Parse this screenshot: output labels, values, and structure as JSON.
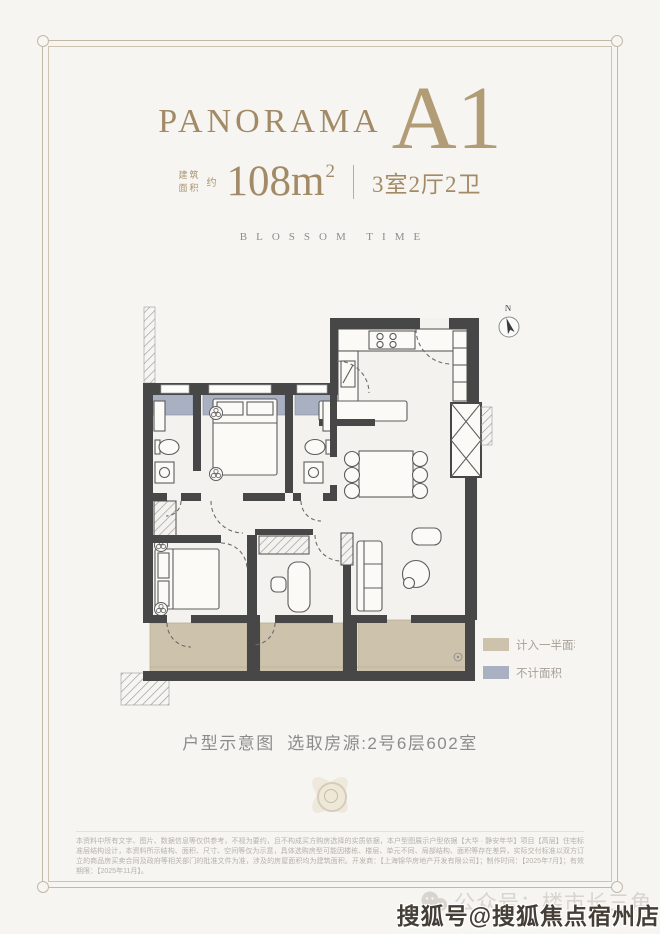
{
  "header": {
    "brand": "PANORAMA",
    "unit": "A1",
    "area_prefix_l1": "建筑",
    "area_prefix_l2": "面积",
    "area_approx": "约",
    "area_number": "108m",
    "area_sup": "2",
    "rooms": "3室2厅2卫",
    "tagline": "BLOSSOM TIME"
  },
  "floorplan": {
    "compass_label": "N",
    "legend": [
      {
        "label": "计入一半面积",
        "color": "#cdc3ad"
      },
      {
        "label": "不计面积",
        "color": "#a8b0c2"
      }
    ]
  },
  "caption": {
    "text": "户型示意图  选取房源:2号6层602室"
  },
  "disclaimer": "本资料中所有文字、图片、数据信息等仅供参考，不视为要约，且不构成买方购房选择的实质依据，本户型图展示户型依据【大华 · 静安年华】项目【高层】住宅标准层结构设计，本资料所示结构、面积、尺寸、空间等仅为示意，具体选购房型可能因楼栋、楼层、单元不同、局部结构、面积等存在差异，实际交付标准以双方订立的商品房买卖合同及政府等相关部门的批准文件为准，涉及的房屋面积均为建筑面积。开发商：【上海锦华房地产开发有限公司】；制作时间：【2025年7月】；有效期限：【2025年11月】。",
  "watermark": {
    "wechat": "公众号：楼市长三角",
    "sohu": "搜狐号@搜狐焦点宿州店"
  },
  "colors": {
    "gold": "#a28a66",
    "gold_light": "#b29c75",
    "wall": "#474747",
    "bay_window": "#a8b0c2",
    "balcony": "#cdc3ad",
    "frame": "#c4b8a6"
  }
}
